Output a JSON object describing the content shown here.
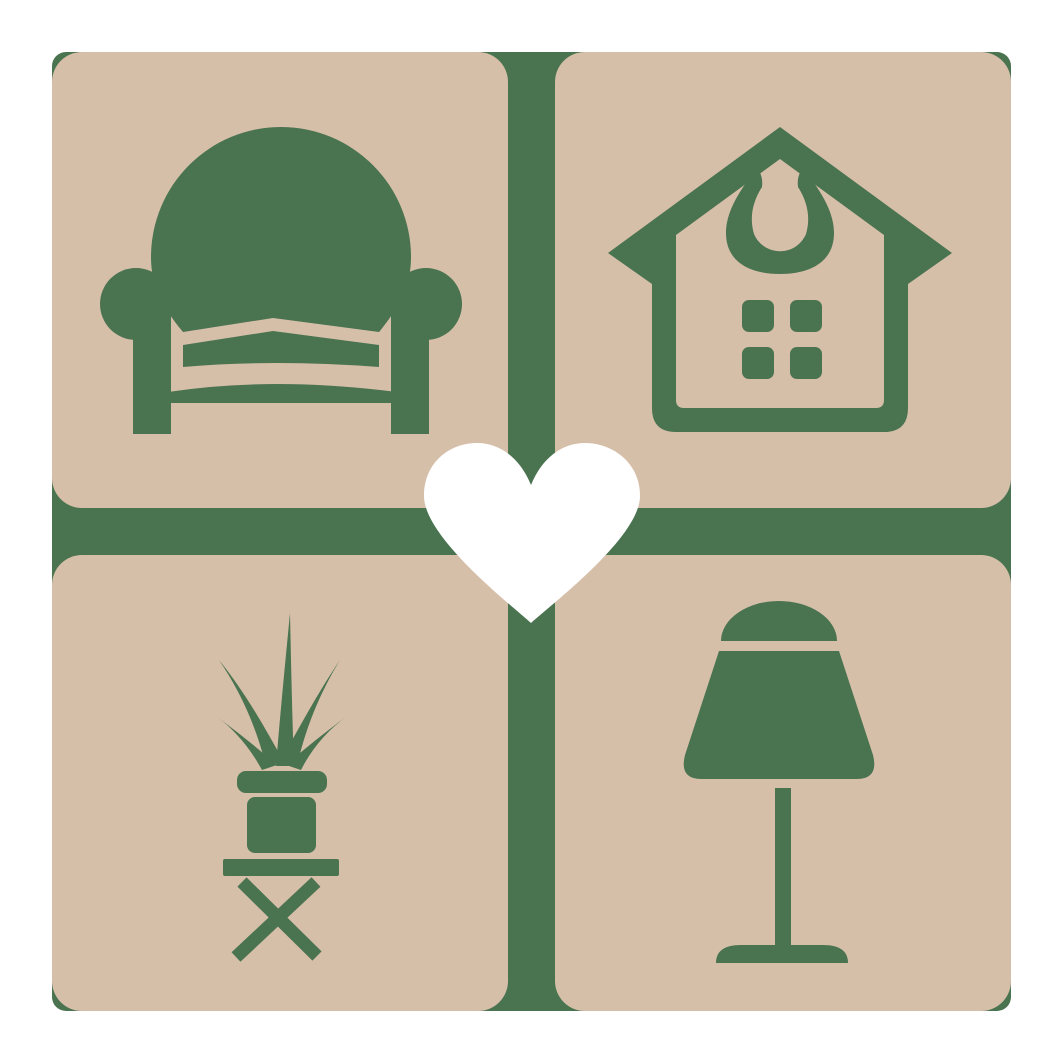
{
  "logo": {
    "description": "Home and furniture logo: four rounded tiles with decor icons around a central heart on a cross divider",
    "colors": {
      "page_background": "#ffffff",
      "tile": "#d6bfa9",
      "accent_green": "#4a7350",
      "heart": "#ffffff"
    },
    "quadrants": [
      {
        "position": "top-left",
        "icon": "armchair-icon"
      },
      {
        "position": "top-right",
        "icon": "house-icon"
      },
      {
        "position": "bottom-left",
        "icon": "potted-plant-icon"
      },
      {
        "position": "bottom-right",
        "icon": "table-lamp-icon"
      }
    ],
    "center": {
      "icon": "heart-icon"
    }
  }
}
